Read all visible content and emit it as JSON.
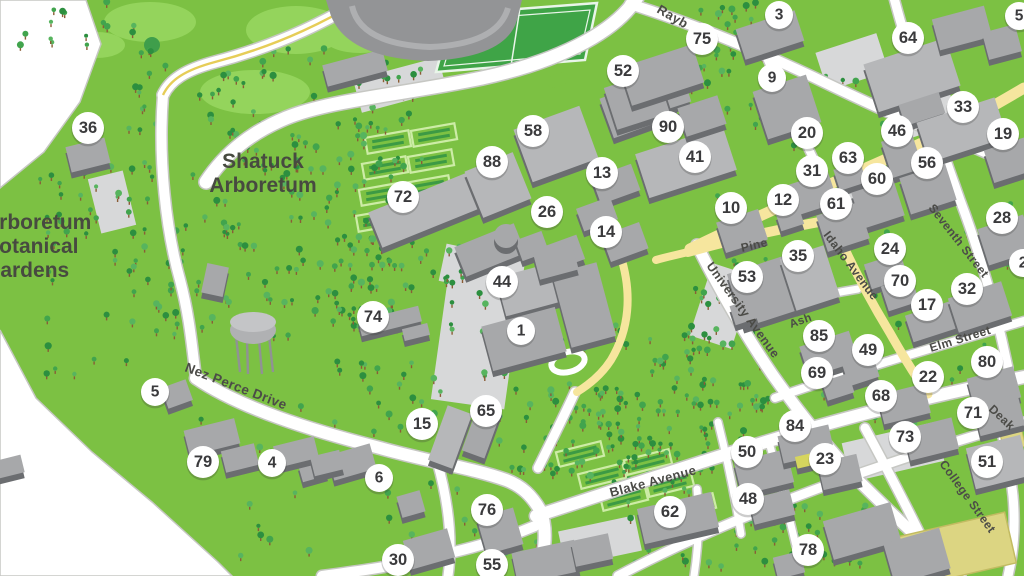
{
  "map": {
    "title": "campus-map",
    "area_labels": [
      {
        "lines": [
          "Shatuck",
          "Arboretum"
        ],
        "x": 263,
        "y": 168,
        "line_h": 24,
        "size": 21,
        "anchor": "middle"
      },
      {
        "lines": [
          "Arboretum",
          "Botanical",
          "Gardens"
        ],
        "x": -16,
        "y": 229,
        "line_h": 24,
        "size": 21,
        "anchor": "start"
      }
    ],
    "street_labels": [
      {
        "text": "Rayb",
        "x": 656,
        "y": 12,
        "rot": 30,
        "size": 13
      },
      {
        "text": "Nez Perce Drive",
        "x": 184,
        "y": 371,
        "rot": 21,
        "size": 13.5
      },
      {
        "text": "Blake Avenue",
        "x": 611,
        "y": 497,
        "rot": -15,
        "size": 13
      },
      {
        "text": "University Avenue",
        "x": 706,
        "y": 266,
        "rot": 54,
        "size": 12.5
      },
      {
        "text": "Pine",
        "x": 742,
        "y": 252,
        "rot": -13,
        "size": 12
      },
      {
        "text": "Idaho Avenue",
        "x": 823,
        "y": 235,
        "rot": 53,
        "size": 12
      },
      {
        "text": "Ash",
        "x": 791,
        "y": 328,
        "rot": -20,
        "size": 11.5
      },
      {
        "text": "Elm Street",
        "x": 931,
        "y": 352,
        "rot": -17,
        "size": 12
      },
      {
        "text": "Seventh Street",
        "x": 928,
        "y": 208,
        "rot": 52,
        "size": 12
      },
      {
        "text": "College Street",
        "x": 939,
        "y": 464,
        "rot": 54,
        "size": 12
      },
      {
        "text": "Deak",
        "x": 988,
        "y": 410,
        "rot": 43,
        "size": 12
      }
    ],
    "markers": [
      {
        "n": "36",
        "x": 88,
        "y": 128
      },
      {
        "n": "72",
        "x": 403,
        "y": 197
      },
      {
        "n": "88",
        "x": 492,
        "y": 162
      },
      {
        "n": "58",
        "x": 533,
        "y": 131
      },
      {
        "n": "26",
        "x": 547,
        "y": 212
      },
      {
        "n": "13",
        "x": 602,
        "y": 173
      },
      {
        "n": "14",
        "x": 606,
        "y": 232
      },
      {
        "n": "90",
        "x": 668,
        "y": 127
      },
      {
        "n": "41",
        "x": 695,
        "y": 157
      },
      {
        "n": "52",
        "x": 623,
        "y": 71
      },
      {
        "n": "75",
        "x": 702,
        "y": 39
      },
      {
        "n": "3",
        "x": 779,
        "y": 15
      },
      {
        "n": "9",
        "x": 772,
        "y": 78
      },
      {
        "n": "20",
        "x": 807,
        "y": 133
      },
      {
        "n": "64",
        "x": 908,
        "y": 38
      },
      {
        "n": "33",
        "x": 963,
        "y": 107
      },
      {
        "n": "46",
        "x": 897,
        "y": 131
      },
      {
        "n": "19",
        "x": 1003,
        "y": 134
      },
      {
        "n": "56",
        "x": 927,
        "y": 163
      },
      {
        "n": "63",
        "x": 848,
        "y": 158
      },
      {
        "n": "31",
        "x": 812,
        "y": 171
      },
      {
        "n": "60",
        "x": 877,
        "y": 179
      },
      {
        "n": "10",
        "x": 731,
        "y": 208
      },
      {
        "n": "12",
        "x": 783,
        "y": 200
      },
      {
        "n": "61",
        "x": 836,
        "y": 204
      },
      {
        "n": "28",
        "x": 1002,
        "y": 218
      },
      {
        "n": "24",
        "x": 890,
        "y": 249
      },
      {
        "n": "53",
        "x": 747,
        "y": 277
      },
      {
        "n": "35",
        "x": 798,
        "y": 256
      },
      {
        "n": "70",
        "x": 900,
        "y": 281
      },
      {
        "n": "17",
        "x": 927,
        "y": 305
      },
      {
        "n": "32",
        "x": 967,
        "y": 289
      },
      {
        "n": "44",
        "x": 502,
        "y": 282
      },
      {
        "n": "1",
        "x": 521,
        "y": 331
      },
      {
        "n": "74",
        "x": 373,
        "y": 317
      },
      {
        "n": "85",
        "x": 819,
        "y": 336
      },
      {
        "n": "49",
        "x": 868,
        "y": 350
      },
      {
        "n": "69",
        "x": 817,
        "y": 373
      },
      {
        "n": "22",
        "x": 928,
        "y": 377
      },
      {
        "n": "68",
        "x": 881,
        "y": 396
      },
      {
        "n": "80",
        "x": 987,
        "y": 362
      },
      {
        "n": "5",
        "x": 155,
        "y": 392
      },
      {
        "n": "15",
        "x": 422,
        "y": 424
      },
      {
        "n": "65",
        "x": 486,
        "y": 411
      },
      {
        "n": "79",
        "x": 203,
        "y": 462
      },
      {
        "n": "4",
        "x": 272,
        "y": 463
      },
      {
        "n": "6",
        "x": 379,
        "y": 478
      },
      {
        "n": "76",
        "x": 487,
        "y": 510
      },
      {
        "n": "30",
        "x": 398,
        "y": 560
      },
      {
        "n": "55",
        "x": 492,
        "y": 565
      },
      {
        "n": "62",
        "x": 670,
        "y": 512
      },
      {
        "n": "84",
        "x": 795,
        "y": 426
      },
      {
        "n": "50",
        "x": 747,
        "y": 452
      },
      {
        "n": "23",
        "x": 825,
        "y": 459
      },
      {
        "n": "48",
        "x": 748,
        "y": 499
      },
      {
        "n": "73",
        "x": 905,
        "y": 437
      },
      {
        "n": "71",
        "x": 973,
        "y": 413
      },
      {
        "n": "51",
        "x": 987,
        "y": 462
      },
      {
        "n": "78",
        "x": 808,
        "y": 550
      },
      {
        "n": "5",
        "x": 1019,
        "y": 16
      },
      {
        "n": "2",
        "x": 1023,
        "y": 263
      }
    ],
    "colors": {
      "grass": "#7cc143",
      "lawn_light": "#94d45c",
      "field_green": "#3fa447",
      "field_line": "#e9f5e9",
      "road_white": "#ffffff",
      "road_casing": "#c6c7c3",
      "road_yellow": "#f6e69e",
      "yellow_line": "#e6cd58",
      "plaza_gray": "#d7d8d9",
      "building_top": "#a7a8aa",
      "building_top_light": "#b6b7b9",
      "building_side": "#6b6d70",
      "building_yellow": "#d6d55e",
      "tan_field": "#dcd582",
      "tan_stroke": "#c2bb62",
      "white_area": "#ffffff",
      "white_edge": "#c6c7c3",
      "tree_dark": "#2c8f3f",
      "tree_mid": "#41a44d",
      "tree_light": "#57b45e",
      "trunk": "#8a5d36",
      "marker_bg": "#ffffff",
      "marker_text": "#3a3a3c",
      "label_text": "#4b4b47",
      "area_label_text": "#474a40"
    },
    "icons": [
      {
        "name": "tree-icon"
      },
      {
        "name": "water-tower-icon"
      },
      {
        "name": "garden-plot-icon"
      }
    ]
  }
}
